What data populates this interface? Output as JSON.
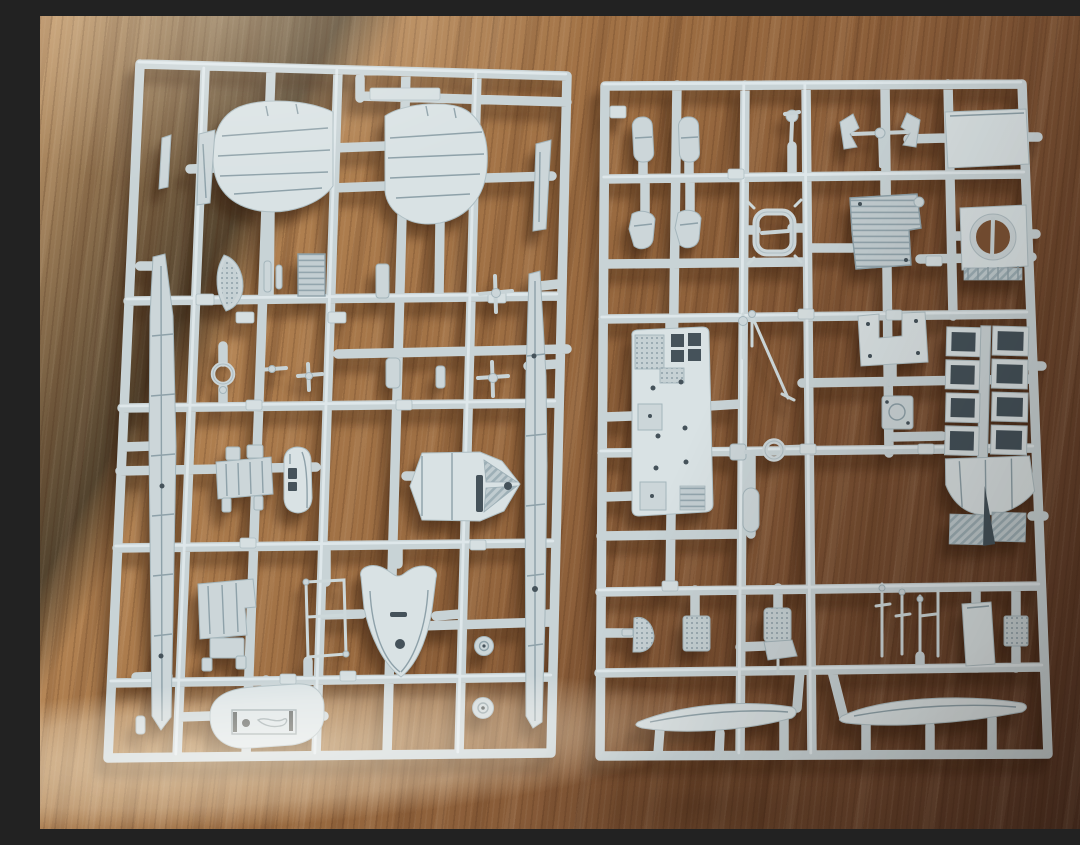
{
  "image": {
    "type": "photograph",
    "subject": "Two light-grey injection-moulded model kit sprues with unassembled aircraft parts, lying on a sunlit oak wood table",
    "aria_label": "Photograph of two plastic model kit sprues on a wooden table"
  },
  "colors": {
    "plastic": "#ccd6d9",
    "plastic_highlight": "#e6eef0",
    "plastic_shadow": "#9fb0b8",
    "part_recess_dark": "#45525a",
    "wood_light": "#c79d6e",
    "wood_mid": "#98693f",
    "wood_dark": "#553525",
    "sunbeam": "rgba(255,236,206,0.62)",
    "cast_shadow": "rgba(52,28,12,0.42)"
  },
  "sprues": [
    {
      "id": "left",
      "label": "left sprue",
      "parts": [
        "tailplane-half-left",
        "tailplane-half-right",
        "tail-fin-small",
        "tail-fin-wedge",
        "wedge-right",
        "float-strut-long-left",
        "float-strut-long-right",
        "seat-back-crescent",
        "radiator-core-ribbed",
        "ring-gasket",
        "engine-block",
        "canopy-spine",
        "cowling-hexagon-plate",
        "cowl-shield-bell",
        "engine-mount-block",
        "windscreen-frame",
        "ventral-hatch-oval",
        "wheel-disc-upper",
        "wheel-disc-lower",
        "small-cross-fittings"
      ]
    },
    {
      "id": "right",
      "label": "right sprue",
      "parts": [
        "cylinder-pill-left",
        "cylinder-pill-right",
        "valve-stem",
        "gun-mount-bracket",
        "flat-access-panel",
        "boot-wedge-left",
        "boot-wedge-right",
        "ring-sight",
        "armoured-seat-ribbed",
        "cowl-ring-finned",
        "cockpit-floor-plate",
        "control-rod-diagonal",
        "towbar-dumbbell",
        "link-pill",
        "bulkhead-yoke",
        "carburettor-box",
        "exhaust-stack-assembly",
        "perforated-fan",
        "perforated-plate",
        "pilot-seat-perforated",
        "lever-rod-cluster",
        "access-door-panel",
        "hatched-plate",
        "leading-edge-slat-left",
        "leading-edge-slat-right"
      ]
    }
  ]
}
